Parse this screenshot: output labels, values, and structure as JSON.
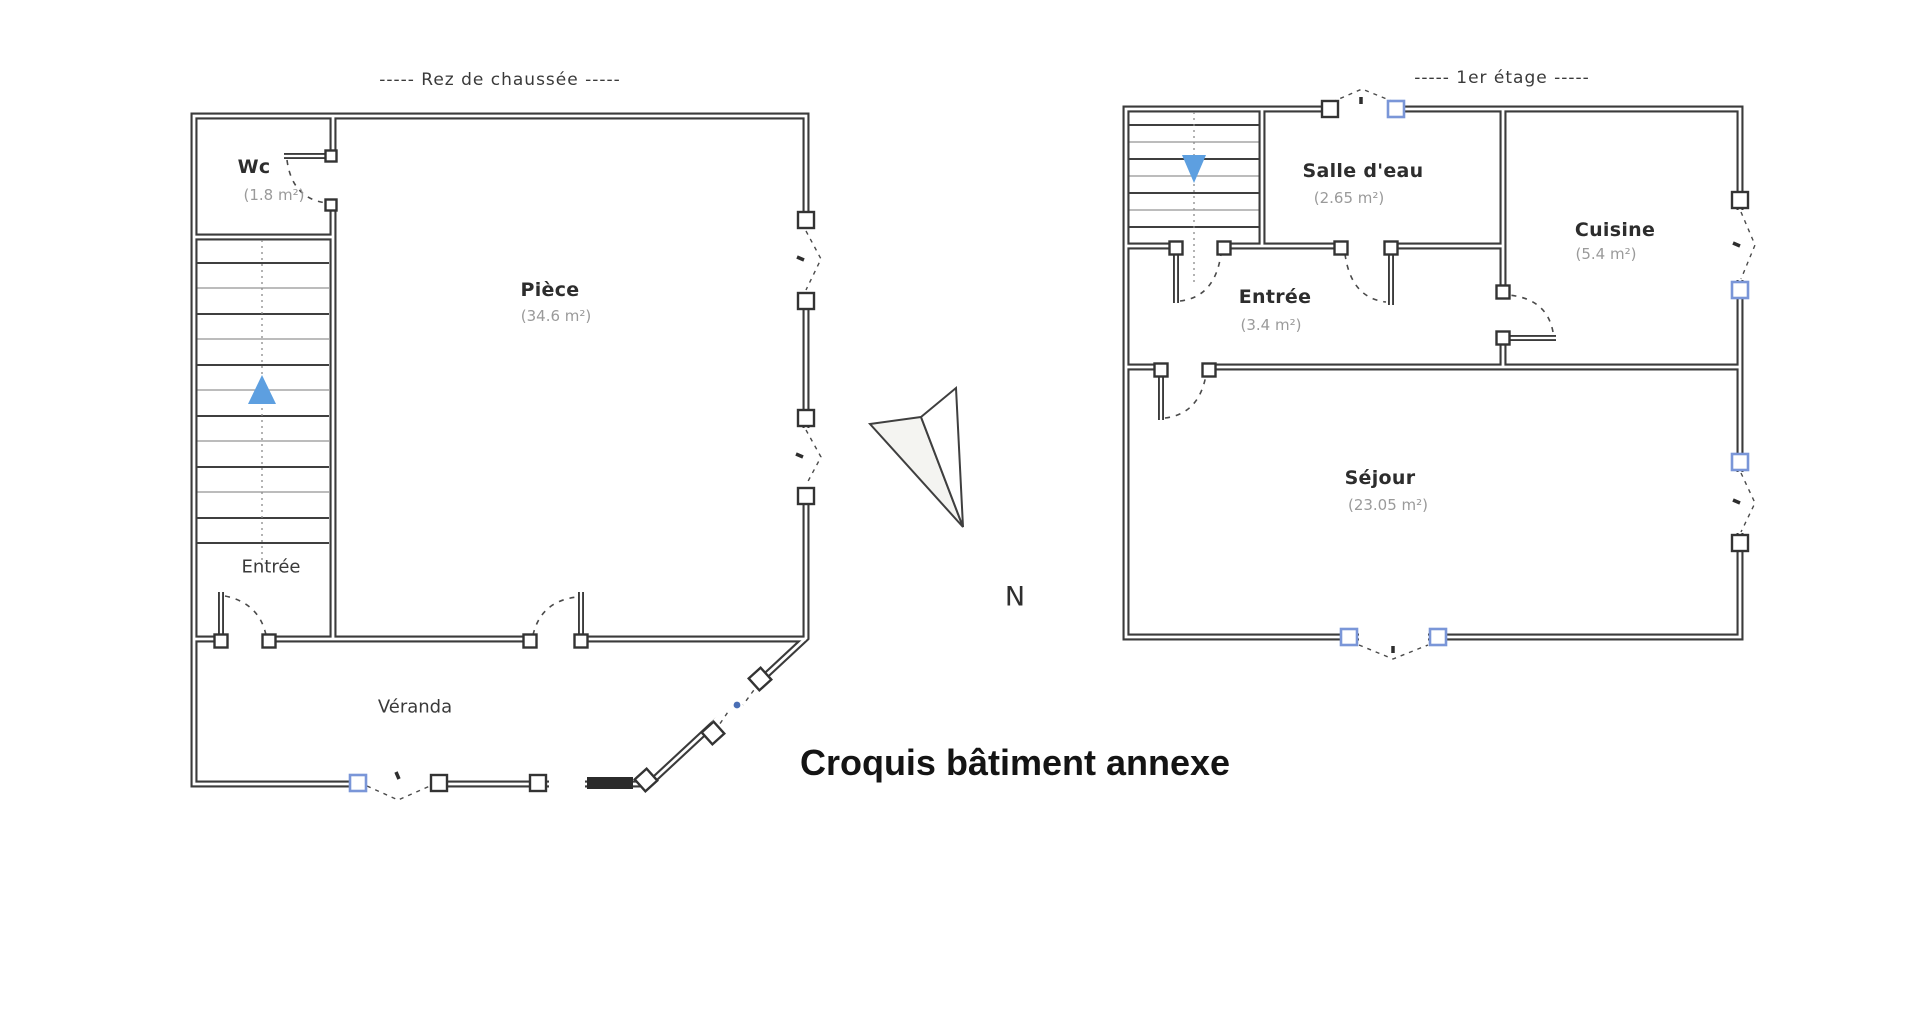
{
  "page": {
    "title": "Croquis bâtiment annexe",
    "north_label": "N"
  },
  "plans": [
    {
      "caption": "-----  Rez de chaussée  -----",
      "rooms": [
        {
          "name": "Wc",
          "area": "(1.8 m²)"
        },
        {
          "name": "Pièce",
          "area": "(34.6 m²)"
        },
        {
          "name": "Entrée",
          "area": ""
        },
        {
          "name": "Véranda",
          "area": ""
        }
      ]
    },
    {
      "caption": "-----  1er étage  -----",
      "rooms": [
        {
          "name": "Salle d'eau",
          "area": "(2.65 m²)"
        },
        {
          "name": "Cuisine",
          "area": "(5.4 m²)"
        },
        {
          "name": "Entrée",
          "area": "(3.4 m²)"
        },
        {
          "name": "Séjour",
          "area": "(23.05 m²)"
        }
      ]
    }
  ],
  "colors": {
    "wall": "#3b3b3b",
    "stairs_arrow_blue": "#5d9fe0",
    "window_marker_blue": "#7a96d8",
    "area_text_gray": "#9a9a9a"
  }
}
